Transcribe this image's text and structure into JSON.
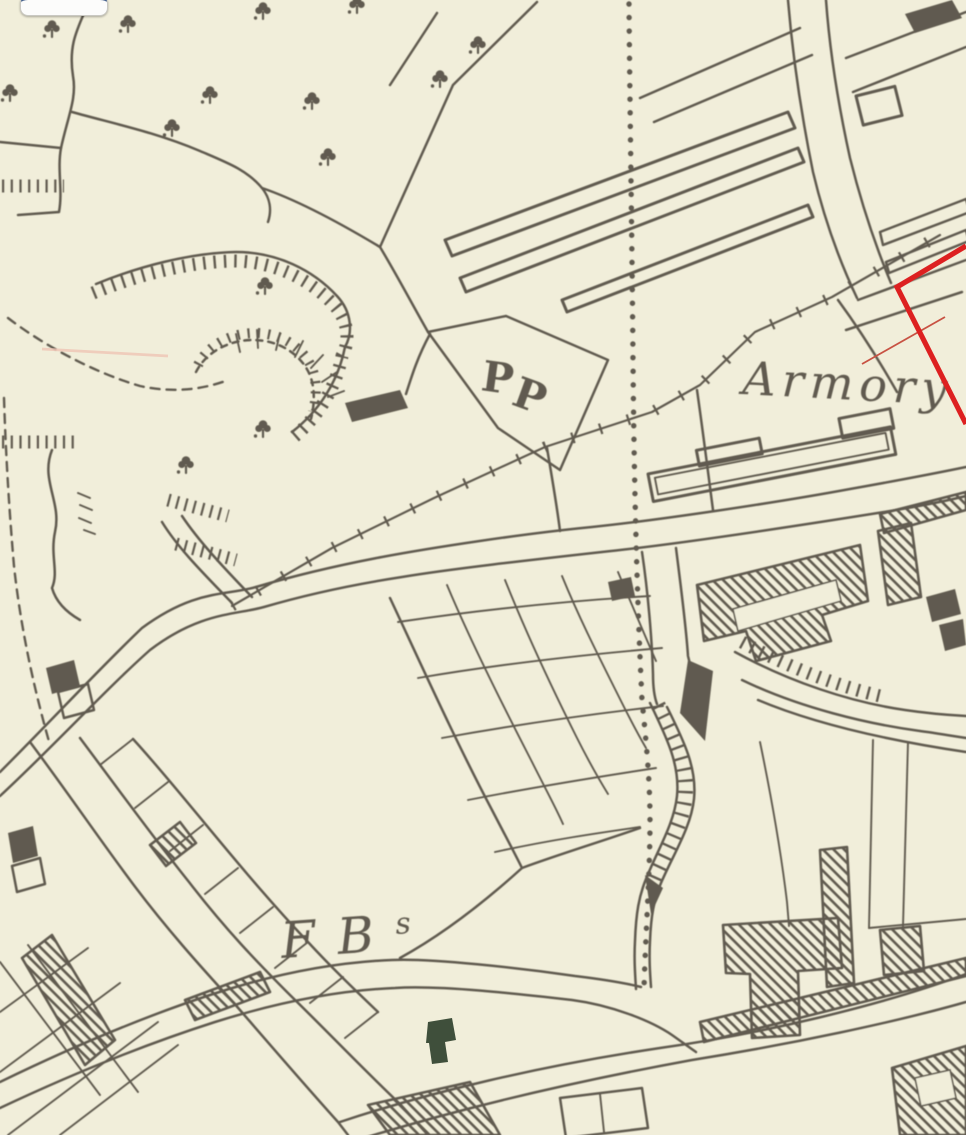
{
  "map": {
    "labels": {
      "armory": "Armory",
      "pp_first": "P",
      "pp_second": "P",
      "fb": "FB",
      "fb_superscript": "s"
    }
  },
  "colors": {
    "paper": "#f1eeda",
    "ink": "#554f44",
    "red": "#dd2020",
    "red_thin": "#c85243",
    "pink": "#efc4b4",
    "ui_navy": "#45618d",
    "ui_white": "#fcfcfb",
    "dark_green": "#3f4f3b"
  }
}
